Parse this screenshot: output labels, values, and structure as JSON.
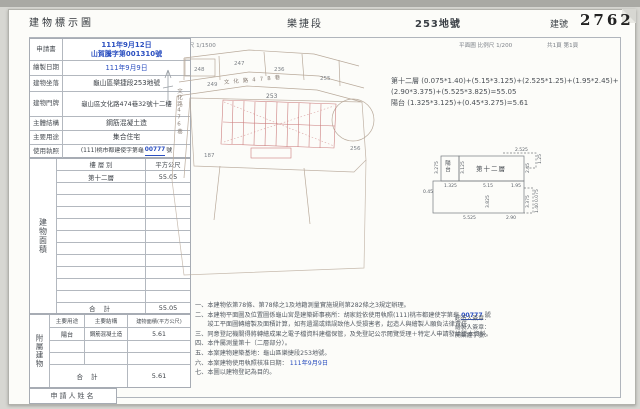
{
  "header": {
    "title": "建物標示圖",
    "section": "樂捷段",
    "lot": "253地號",
    "building_no_label": "建號",
    "building_no": "2762"
  },
  "scales": {
    "location_scale": "位置圖 比例尺 1/1500",
    "floor_scale": "平面圖 比例尺 1/200",
    "pages": "共1頁 第1頁"
  },
  "info": {
    "rows": [
      {
        "label": "申請書",
        "value": "111年9月12日",
        "value2": "山賀騰字第001310號"
      },
      {
        "label": "繪製日期",
        "value": "111年9月9日"
      },
      {
        "label": "建物坐落",
        "value": "龜山區樂捷段253地號"
      },
      {
        "label": "建物門牌",
        "value": "龜山區文化路474巷32號十二樓"
      },
      {
        "label": "主體結構",
        "value": "鋼筋混凝土造"
      },
      {
        "label": "主要用途",
        "value": "集合住宅"
      },
      {
        "label": "使用執照",
        "value_pre": "(111)桃市都建使字第龜",
        "value_num": "00777",
        "value_post": "號"
      }
    ]
  },
  "area_table": {
    "vertical_label": "建物面積",
    "col_floor": "樓 層 別",
    "col_sqm": "平方公尺",
    "rows": [
      {
        "floor": "第十二層",
        "sqm": "55.05"
      }
    ],
    "total_label": "合  計",
    "total": "55.05"
  },
  "attached_table": {
    "vertical_label": "附屬建物",
    "col_use": "主要用途",
    "col_structure": "主要結構",
    "col_area": "建物面積(平方公尺)",
    "rows": [
      {
        "use": "陽台",
        "structure": "鋼筋混凝土造",
        "area": "5.61"
      }
    ],
    "total_label": "合  計",
    "total": "5.61"
  },
  "applicant": {
    "label": "申請人姓名"
  },
  "site_plan": {
    "lots": {
      "l248": "248",
      "l247": "247",
      "l249": "249",
      "l236": "236",
      "l255": "255",
      "l253": "253",
      "l256": "256",
      "l187": "187"
    },
    "road_top": "文化路478巷",
    "road_left": "文化路476巷"
  },
  "formulas": {
    "line1": "第十二層 (0.075*1.40)+(5.15*3.125)+(2.525*1.25)+(1.95*2.45)+",
    "line2": "(2.90*3.375)+(5.525*3.825)=55.05",
    "line3": "陽台 (1.325*3.125)+(0.45*3.275)=5.61"
  },
  "floor_plan": {
    "room": "第十二層",
    "balcony": "陽台",
    "dims": {
      "d2525": "2.525",
      "d125": "1.25",
      "d3275": "3.275",
      "d3125": "3.125",
      "d245": "2.45",
      "d1325": "1.325",
      "d515": "5.15",
      "d195": "1.95",
      "d045": "0.45",
      "d3825": "3.825",
      "d3375": "3.375",
      "d0075": "0.075",
      "d140": "1.40",
      "d5525": "5.525",
      "d290": "2.90"
    }
  },
  "notes": {
    "n1": "一、本建物依第78條、第78條之1及地籍測量實施規則第282條之3規定辦理。",
    "n2_pre": "二、本建物平面圖及位置圖係龜山宮是建築師事務所：胡家銓依使用執照(111)桃市都建使字第龜",
    "n2_num": "00777",
    "n2_post": " 號",
    "n2b": "　　竣工平面圖轉繪製及面積計算，如有遺漏或錯誤致他人受損害者，起造人與繪製人願負法律責任。",
    "n3": "三、同意登記機關得將轉繪成果之電子檔資料建檔保管，及免登記公示閱覽受理＋特定人申請發給謄本資料。",
    "n4": "四、本件屬測量第十（二層部分）。",
    "n5": "五、本案建物建築基地：龜山區樂捷段253地號。",
    "n6_pre": "六、本案建物使用執照核准日期：",
    "n6_date": "111年9月9日",
    "n7": "七、本圖以建物登記為目的。",
    "sig1": "起造人簽章：",
    "sig2": "繪製人簽章：",
    "sig3": "開業證字號："
  },
  "colors": {
    "accent_blue": "#2b4fc0",
    "plan_red": "#cc7f7f",
    "boundary": "#b9aa9b"
  }
}
